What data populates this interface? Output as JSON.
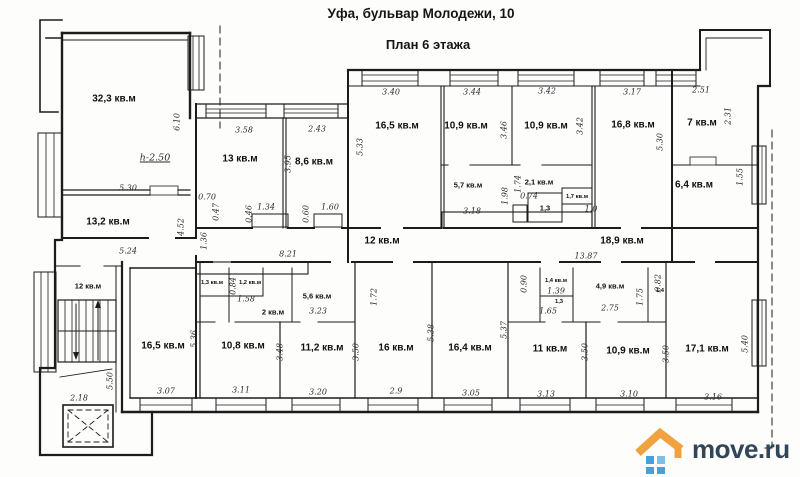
{
  "header": {
    "title": "Уфа, бульвар Молодежи, 10",
    "subtitle": "План  6 этажа"
  },
  "watermark": {
    "text": "move.ru",
    "colors": {
      "text": "#32465a",
      "roof": "#f0a23e",
      "windows": "#45a1d8"
    }
  },
  "plan": {
    "unit_suffix": "кв.м",
    "rooms": [
      {
        "label": "32,3 кв.м",
        "x": 114,
        "y": 99,
        "s": "lg"
      },
      {
        "label": "13 кв.м",
        "x": 240,
        "y": 159,
        "s": "lg"
      },
      {
        "label": "8,6 кв.м",
        "x": 314,
        "y": 162,
        "s": "lg"
      },
      {
        "label": "16,5 кв.м",
        "x": 397,
        "y": 126,
        "s": "lg"
      },
      {
        "label": "10,9 кв.м",
        "x": 466,
        "y": 126,
        "s": "lg"
      },
      {
        "label": "10,9 кв.м",
        "x": 546,
        "y": 126,
        "s": "lg"
      },
      {
        "label": "16,8 кв.м",
        "x": 633,
        "y": 125,
        "s": "lg"
      },
      {
        "label": "7 кв.м",
        "x": 702,
        "y": 123,
        "s": "lg"
      },
      {
        "label": "5,7 кв.м",
        "x": 468,
        "y": 185,
        "s": "md"
      },
      {
        "label": "2,1 кв.м",
        "x": 539,
        "y": 182,
        "s": "md"
      },
      {
        "label": "1,3",
        "x": 545,
        "y": 208,
        "s": "md"
      },
      {
        "label": "1,7 кв.м",
        "x": 577,
        "y": 197,
        "s": "sm"
      },
      {
        "label": "6,4 кв.м",
        "x": 694,
        "y": 185,
        "s": "lg"
      },
      {
        "label": "13,2 кв.м",
        "x": 108,
        "y": 222,
        "s": "lg"
      },
      {
        "label": "12 кв.м",
        "x": 382,
        "y": 241,
        "s": "lg"
      },
      {
        "label": "18,9 кв.м",
        "x": 622,
        "y": 241,
        "s": "lg"
      },
      {
        "label": "12 кв.м",
        "x": 88,
        "y": 286,
        "s": "md"
      },
      {
        "label": "1,3 кв.м",
        "x": 212,
        "y": 283,
        "s": "sm"
      },
      {
        "label": "1,2 кв.м",
        "x": 250,
        "y": 283,
        "s": "sm"
      },
      {
        "label": "2 кв.м",
        "x": 273,
        "y": 312,
        "s": "md"
      },
      {
        "label": "5,6 кв.м",
        "x": 317,
        "y": 296,
        "s": "md"
      },
      {
        "label": "1,4 кв.м",
        "x": 556,
        "y": 281,
        "s": "sm"
      },
      {
        "label": "1,3",
        "x": 559,
        "y": 302,
        "s": "sm"
      },
      {
        "label": "4,9 кв.м",
        "x": 610,
        "y": 286,
        "s": "md"
      },
      {
        "label": "1,4",
        "x": 660,
        "y": 291,
        "s": "sm"
      },
      {
        "label": "16,5 кв.м",
        "x": 163,
        "y": 346,
        "s": "lg"
      },
      {
        "label": "10,8 кв.м",
        "x": 243,
        "y": 346,
        "s": "lg"
      },
      {
        "label": "11,2 кв.м",
        "x": 322,
        "y": 348,
        "s": "lg"
      },
      {
        "label": "16 кв.м",
        "x": 396,
        "y": 348,
        "s": "lg"
      },
      {
        "label": "16,4 кв.м",
        "x": 470,
        "y": 348,
        "s": "lg"
      },
      {
        "label": "11 кв.м",
        "x": 550,
        "y": 349,
        "s": "lg"
      },
      {
        "label": "10,9 кв.м",
        "x": 628,
        "y": 351,
        "s": "lg"
      },
      {
        "label": "17,1 кв.м",
        "x": 707,
        "y": 349,
        "s": "lg"
      }
    ],
    "dims": [
      {
        "label": "6.10",
        "x": 177,
        "y": 122,
        "v": true
      },
      {
        "label": "5.30",
        "x": 128,
        "y": 188
      },
      {
        "label": "h-2.50",
        "x": 155,
        "y": 158,
        "u": true
      },
      {
        "label": "5.24",
        "x": 128,
        "y": 251
      },
      {
        "label": "4.52",
        "x": 181,
        "y": 227,
        "v": true
      },
      {
        "label": "1.36",
        "x": 204,
        "y": 241,
        "v": true
      },
      {
        "label": "0.70",
        "x": 207,
        "y": 197
      },
      {
        "label": "0.47",
        "x": 216,
        "y": 212,
        "v": true
      },
      {
        "label": "3.58",
        "x": 244,
        "y": 130
      },
      {
        "label": "2.43",
        "x": 317,
        "y": 129
      },
      {
        "label": "3.95",
        "x": 288,
        "y": 164,
        "v": true
      },
      {
        "label": "0.46",
        "x": 249,
        "y": 214,
        "v": true
      },
      {
        "label": "1.34",
        "x": 266,
        "y": 207
      },
      {
        "label": "0.60",
        "x": 306,
        "y": 214,
        "v": true
      },
      {
        "label": "1.60",
        "x": 330,
        "y": 207
      },
      {
        "label": "5.33",
        "x": 360,
        "y": 147,
        "v": true
      },
      {
        "label": "3.40",
        "x": 391,
        "y": 92
      },
      {
        "label": "3.44",
        "x": 472,
        "y": 92
      },
      {
        "label": "3.46",
        "x": 504,
        "y": 130,
        "v": true
      },
      {
        "label": "3.42",
        "x": 547,
        "y": 91
      },
      {
        "label": "3.42",
        "x": 580,
        "y": 126,
        "v": true
      },
      {
        "label": "3.17",
        "x": 632,
        "y": 92
      },
      {
        "label": "2.51",
        "x": 701,
        "y": 90
      },
      {
        "label": "2.31",
        "x": 728,
        "y": 116,
        "v": true
      },
      {
        "label": "5.30",
        "x": 660,
        "y": 142,
        "v": true
      },
      {
        "label": "1.55",
        "x": 740,
        "y": 177,
        "v": true
      },
      {
        "label": "3.18",
        "x": 472,
        "y": 211
      },
      {
        "label": "1.98",
        "x": 505,
        "y": 196,
        "v": true
      },
      {
        "label": "1.74",
        "x": 518,
        "y": 184,
        "v": true
      },
      {
        "label": "0.74",
        "x": 529,
        "y": 196
      },
      {
        "label": "1.0",
        "x": 591,
        "y": 209
      },
      {
        "label": "8.21",
        "x": 288,
        "y": 254
      },
      {
        "label": "13.87",
        "x": 586,
        "y": 256
      },
      {
        "label": "0.84",
        "x": 233,
        "y": 286,
        "v": true
      },
      {
        "label": "1.58",
        "x": 246,
        "y": 299
      },
      {
        "label": "3.23",
        "x": 318,
        "y": 311
      },
      {
        "label": "1.72",
        "x": 374,
        "y": 297,
        "v": true
      },
      {
        "label": "0.90",
        "x": 524,
        "y": 284,
        "v": true
      },
      {
        "label": "1.39",
        "x": 556,
        "y": 291
      },
      {
        "label": "1.65",
        "x": 548,
        "y": 311
      },
      {
        "label": "2.75",
        "x": 610,
        "y": 308
      },
      {
        "label": "1.75",
        "x": 640,
        "y": 297,
        "v": true
      },
      {
        "label": "0.82",
        "x": 658,
        "y": 283,
        "v": true
      },
      {
        "label": "5.50",
        "x": 110,
        "y": 381,
        "v": true
      },
      {
        "label": "2.18",
        "x": 79,
        "y": 398
      },
      {
        "label": "5.36",
        "x": 194,
        "y": 339,
        "v": true
      },
      {
        "label": "3.48",
        "x": 280,
        "y": 352,
        "v": true
      },
      {
        "label": "3.50",
        "x": 356,
        "y": 352,
        "v": true
      },
      {
        "label": "5.38",
        "x": 431,
        "y": 333,
        "v": true
      },
      {
        "label": "5.37",
        "x": 504,
        "y": 330,
        "v": true
      },
      {
        "label": "3.50",
        "x": 585,
        "y": 352,
        "v": true
      },
      {
        "label": "3.50",
        "x": 666,
        "y": 354,
        "v": true
      },
      {
        "label": "5.40",
        "x": 745,
        "y": 344,
        "v": true
      },
      {
        "label": "3.07",
        "x": 166,
        "y": 391
      },
      {
        "label": "3.11",
        "x": 241,
        "y": 390
      },
      {
        "label": "3.20",
        "x": 318,
        "y": 392
      },
      {
        "label": "2.9",
        "x": 396,
        "y": 391
      },
      {
        "label": "3.05",
        "x": 471,
        "y": 393
      },
      {
        "label": "3.13",
        "x": 546,
        "y": 394
      },
      {
        "label": "3.10",
        "x": 629,
        "y": 394
      },
      {
        "label": "3.16",
        "x": 713,
        "y": 397
      }
    ]
  }
}
